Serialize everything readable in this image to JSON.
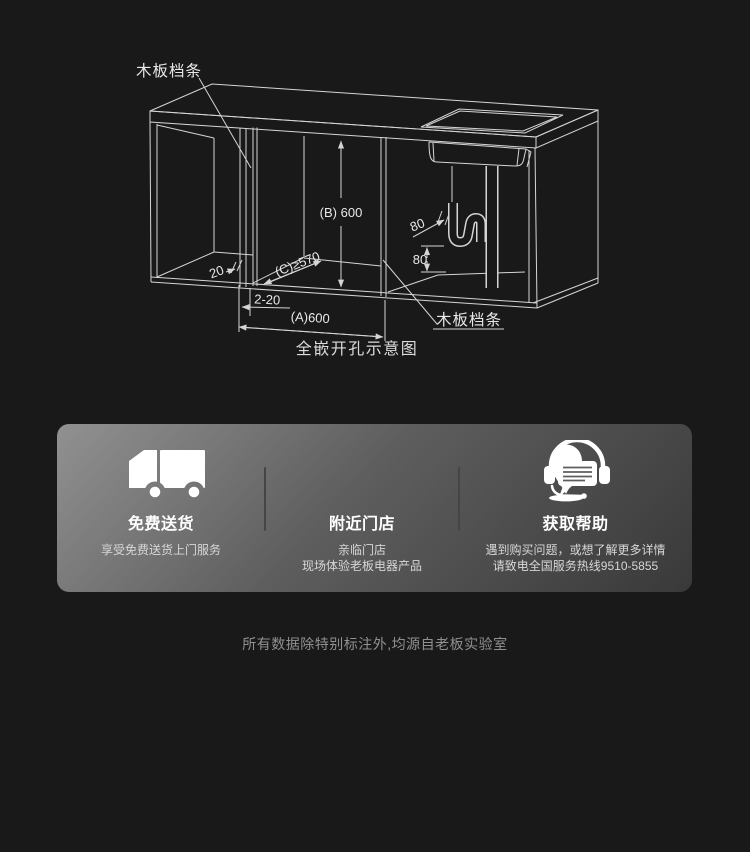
{
  "diagram": {
    "caption": "全嵌开孔示意图",
    "label_top_left": "木板档条",
    "label_bottom_right": "木板档条",
    "dims": {
      "b": "(B) 600",
      "c": "(C)≥570",
      "a": "(A)600",
      "gap": "2-20",
      "strip_depth": "20",
      "trap_offset": "80",
      "trap_height": "80"
    }
  },
  "services": {
    "items": [
      {
        "icon": "truck-icon",
        "title": "免费送货",
        "line1": "享受免费送货上门服务",
        "line2": ""
      },
      {
        "icon": "location-pin-icon",
        "title": "附近门店",
        "line1": "亲临门店",
        "line2": "现场体验老板电器产品"
      },
      {
        "icon": "headset-icon",
        "title": "获取帮助",
        "line1": "遇到购买问题，或想了解更多详情",
        "line2": "请致电全国服务热线9510-5855"
      }
    ]
  },
  "footnote": "所有数据除特别标注外,均源自老板实验室",
  "colors": {
    "background": "#191919",
    "diagram_line": "#d5d5d5",
    "card_gradient_start": "#8f8f8f",
    "card_gradient_end": "#393939",
    "text_primary": "#ffffff",
    "text_secondary": "#d7d7d7",
    "footnote_text": "#909090"
  }
}
